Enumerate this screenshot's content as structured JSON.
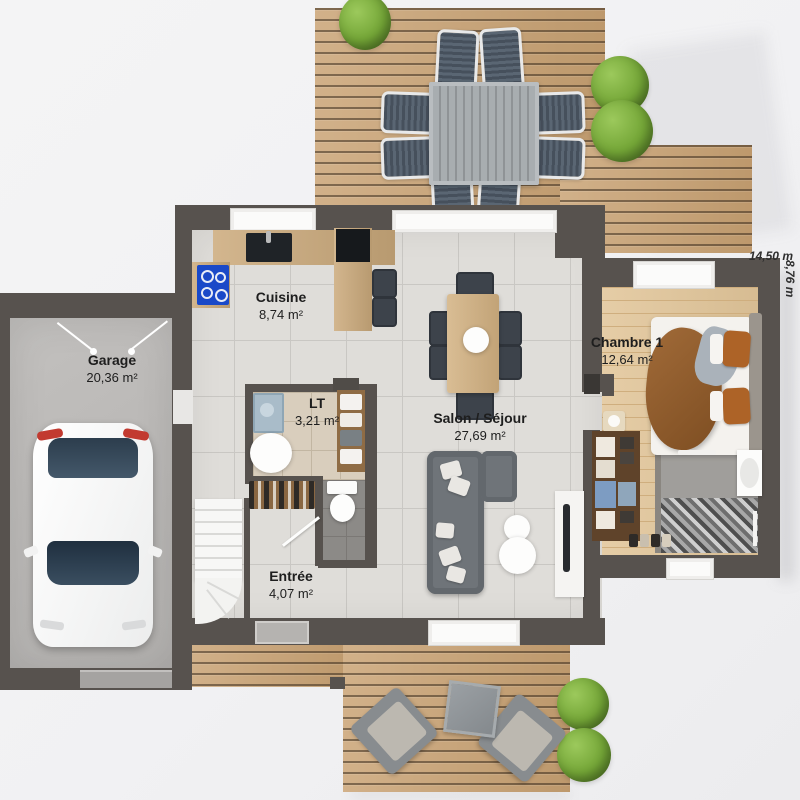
{
  "plan_title": "Floor plan — ground floor",
  "rooms": [
    {
      "name": "Garage",
      "area": "20,36 m²"
    },
    {
      "name": "Cuisine",
      "area": "8,74 m²"
    },
    {
      "name": "LT",
      "area": "3,21 m²"
    },
    {
      "name": "Salon / Séjour",
      "area": "27,69 m²"
    },
    {
      "name": "Chambre 1",
      "area": "12,64 m²"
    },
    {
      "name": "Entrée",
      "area": "4,07 m²"
    }
  ],
  "dimensions": {
    "width_label": "14,50 m",
    "height_label": "8,76 m"
  },
  "colors": {
    "wall": "#57524e",
    "deck_wood": "#c9a273",
    "tile_floor": "#dfddd9",
    "bedroom_wood": "#e2c69a",
    "tree_green": "#74a637",
    "hob_blue": "#1a49c8",
    "blanket_brown": "#935d2f",
    "sofa_gray": "#6f7479"
  }
}
